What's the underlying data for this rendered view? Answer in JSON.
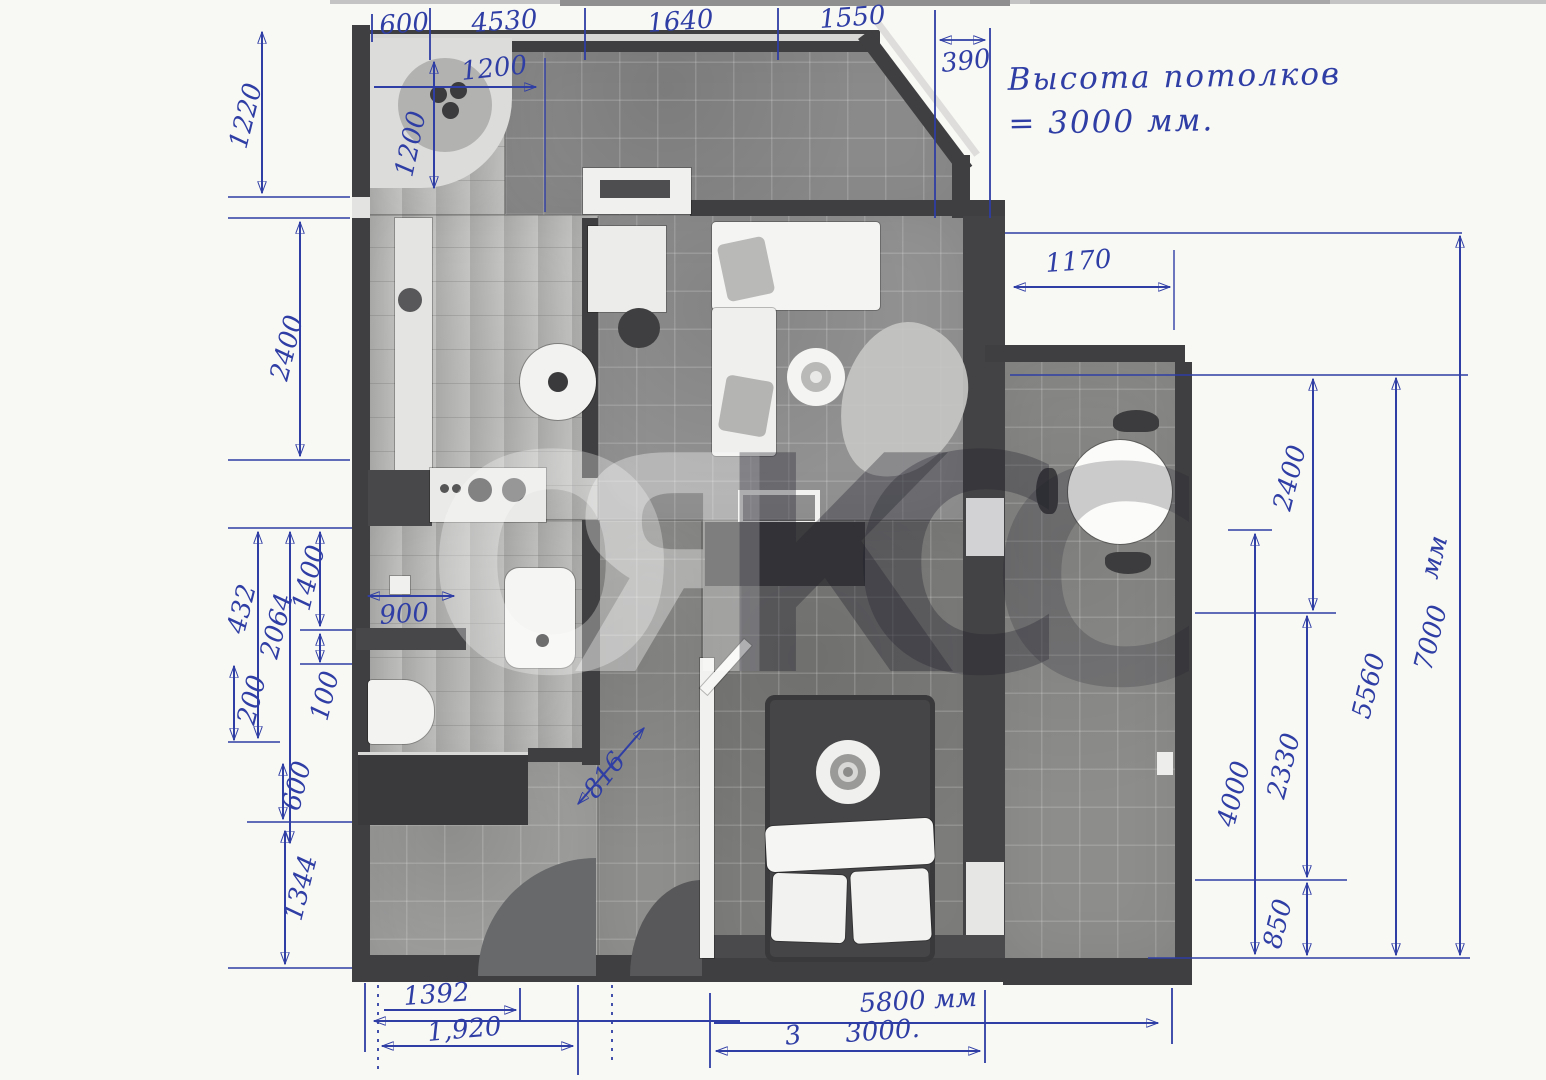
{
  "note": {
    "line1": "Высота потолков",
    "line2": "= 3000 мм."
  },
  "watermark": {
    "letters": [
      "О",
      "Я",
      "К",
      "С",
      "С"
    ]
  },
  "dims": {
    "top": [
      "600",
      "4530",
      "1640",
      "1550",
      "390"
    ],
    "left": [
      "1220",
      "2400",
      "432",
      "2064",
      "1400",
      "100",
      "200",
      "600",
      "1344"
    ],
    "right": [
      "1170",
      "2400",
      "4000",
      "2330",
      "850",
      "5560",
      "7000",
      "мм"
    ],
    "bottom": [
      "1392",
      "1,920",
      "5800 мм",
      "3",
      "3000."
    ],
    "interior": [
      "1200",
      "1200",
      "900",
      "816"
    ]
  },
  "colors": {
    "ink": "#2f3ea4",
    "wall": "#3f3f41",
    "paper": "#f8f8f5"
  }
}
